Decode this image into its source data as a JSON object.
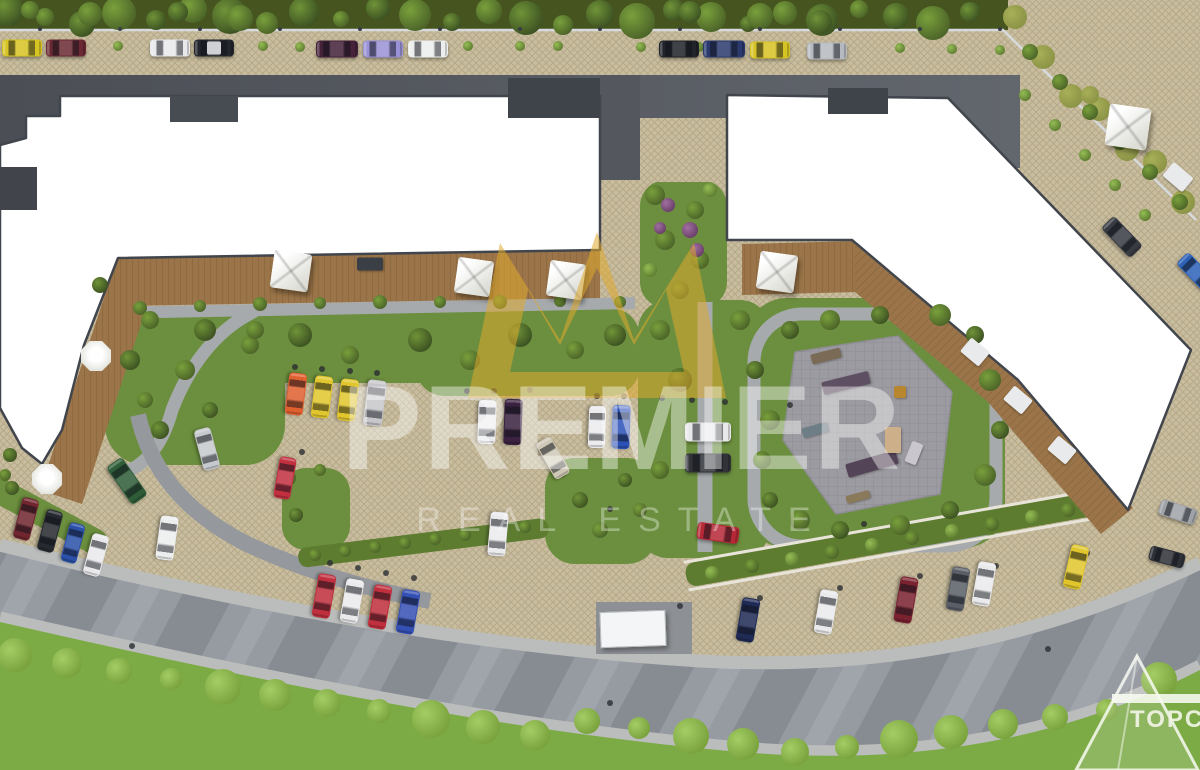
{
  "meta": {
    "description": "Aerial 3D architectural rendering of a residential complex master plan with parking areas, landscaped courtyard and playground"
  },
  "watermark": {
    "brand": "PREMIER",
    "tagline": "REAL ESTATE",
    "crown_color": "rgba(222,170,45,0.55)",
    "brand_color": "rgba(255,255,255,0.42)",
    "tagline_color": "rgba(255,255,255,0.34)"
  },
  "corner_logo": {
    "text": "TOPCH"
  },
  "palette": {
    "pavement_beige": "#c9bd9f",
    "road_dark": "#54575e",
    "road_light": "#969aa1",
    "sidewalk": "#babdbb",
    "grass_bright": "#7cab46",
    "grass_mid": "#6b8f3e",
    "hedge_dark": "#46541f",
    "field_olive": "#8b9346",
    "deck_wood": "#9b7549",
    "building_white": "#ffffff",
    "building_outline": "#41454c",
    "plaza_gray": "#9c9ba1"
  },
  "scene": {
    "cars": [
      [
        22,
        48,
        0,
        40,
        17,
        "#d6c324"
      ],
      [
        66,
        48,
        0,
        40,
        17,
        "#6b2a33"
      ],
      [
        170,
        48,
        0,
        40,
        17,
        "#e9e9ec"
      ],
      [
        214,
        48,
        0,
        40,
        17,
        "#23262c",
        "#dcdde0"
      ],
      [
        337,
        49,
        0,
        42,
        17,
        "#45223a"
      ],
      [
        383,
        49,
        0,
        40,
        17,
        "#9a92d6"
      ],
      [
        428,
        49,
        0,
        40,
        17,
        "#eceded"
      ],
      [
        679,
        49,
        0,
        40,
        17,
        "#202329"
      ],
      [
        724,
        49,
        0,
        42,
        17,
        "#2b3a6e"
      ],
      [
        770,
        50,
        0,
        40,
        17,
        "#d6c324"
      ],
      [
        827,
        51,
        0,
        40,
        17,
        "#b6bac0"
      ],
      [
        1122,
        237,
        46,
        42,
        18,
        "#383b42"
      ],
      [
        1196,
        272,
        46,
        40,
        17,
        "#2d62b8"
      ],
      [
        296,
        394,
        97,
        42,
        18,
        "#e06030"
      ],
      [
        322,
        397,
        97,
        42,
        18,
        "#e0c62c"
      ],
      [
        348,
        400,
        97,
        42,
        18,
        "#e0c62c"
      ],
      [
        375,
        403,
        97,
        46,
        19,
        "#c7c7cb"
      ],
      [
        285,
        478,
        100,
        42,
        17,
        "#c23040"
      ],
      [
        487,
        422,
        92,
        44,
        18,
        "#ebebee"
      ],
      [
        513,
        422,
        92,
        46,
        18,
        "#3a2240"
      ],
      [
        553,
        458,
        60,
        42,
        17,
        "#cfc8b6"
      ],
      [
        597,
        427,
        92,
        42,
        17,
        "#ebebee"
      ],
      [
        621,
        427,
        92,
        44,
        18,
        "#2c52b8"
      ],
      [
        708,
        432,
        0,
        46,
        19,
        "#e8e8eb"
      ],
      [
        708,
        463,
        0,
        46,
        19,
        "#313339"
      ],
      [
        718,
        533,
        8,
        42,
        17,
        "#b52836"
      ],
      [
        498,
        534,
        95,
        44,
        18,
        "#ebebee"
      ],
      [
        26,
        519,
        105,
        42,
        17,
        "#70252f"
      ],
      [
        50,
        531,
        105,
        42,
        17,
        "#26292f"
      ],
      [
        73,
        543,
        105,
        40,
        16,
        "#2a50a8"
      ],
      [
        96,
        555,
        105,
        42,
        17,
        "#e9e9ec"
      ],
      [
        207,
        449,
        75,
        42,
        17,
        "#c6c9cd"
      ],
      [
        127,
        481,
        55,
        46,
        19,
        "#2f5d38"
      ],
      [
        167,
        538,
        98,
        44,
        18,
        "#eceded"
      ],
      [
        324,
        596,
        100,
        44,
        18,
        "#bf2f3d"
      ],
      [
        352,
        601,
        100,
        44,
        18,
        "#eaeaec"
      ],
      [
        380,
        607,
        100,
        44,
        18,
        "#bf2f3d"
      ],
      [
        408,
        612,
        100,
        44,
        18,
        "#3550b5"
      ],
      [
        748,
        620,
        100,
        44,
        18,
        "#1f2a55"
      ],
      [
        826,
        612,
        100,
        44,
        18,
        "#eaeaec"
      ],
      [
        906,
        600,
        100,
        46,
        18,
        "#7a2230"
      ],
      [
        958,
        589,
        100,
        44,
        18,
        "#5a5e66"
      ],
      [
        984,
        584,
        100,
        44,
        18,
        "#eaeaec"
      ],
      [
        1076,
        567,
        103,
        44,
        18,
        "#e0c62c"
      ],
      [
        1178,
        512,
        18,
        38,
        16,
        "#9fa3a8"
      ],
      [
        1167,
        557,
        15,
        36,
        15,
        "#2e3138"
      ]
    ],
    "gazebos": [
      [
        291,
        271,
        38
      ],
      [
        474,
        277,
        36
      ],
      [
        566,
        280,
        36
      ],
      [
        777,
        272,
        38
      ],
      [
        1128,
        127,
        42
      ]
    ],
    "umbrellas": [
      [
        96,
        356,
        30
      ],
      [
        47,
        479,
        30
      ]
    ],
    "furniture": [
      [
        370,
        264,
        26,
        13,
        0,
        "#3a3f46"
      ],
      [
        975,
        352,
        24,
        18,
        40,
        "#e9eaeb"
      ],
      [
        1018,
        400,
        24,
        18,
        40,
        "#e9eaeb"
      ],
      [
        1062,
        450,
        24,
        18,
        40,
        "#e9eaeb"
      ],
      [
        1178,
        177,
        26,
        18,
        40,
        "#e9eaeb"
      ]
    ],
    "playground_equipment": [
      [
        846,
        383,
        48,
        13,
        -14,
        "#5f4f63"
      ],
      [
        826,
        356,
        30,
        10,
        -14,
        "#7b6a55"
      ],
      [
        872,
        464,
        52,
        14,
        -16,
        "#544458"
      ],
      [
        893,
        440,
        16,
        26,
        0,
        "#cdb089"
      ],
      [
        914,
        453,
        12,
        22,
        22,
        "#c9c7cd"
      ],
      [
        858,
        497,
        24,
        8,
        -15,
        "#8a7a5a"
      ],
      [
        815,
        430,
        26,
        10,
        -15,
        "#6e7e86"
      ],
      [
        900,
        392,
        12,
        12,
        0,
        "#b8862f"
      ]
    ],
    "truck": {
      "x": 632,
      "y": 628,
      "w": 64,
      "h": 34,
      "rot": -2,
      "color": "#f4f5f6"
    }
  }
}
